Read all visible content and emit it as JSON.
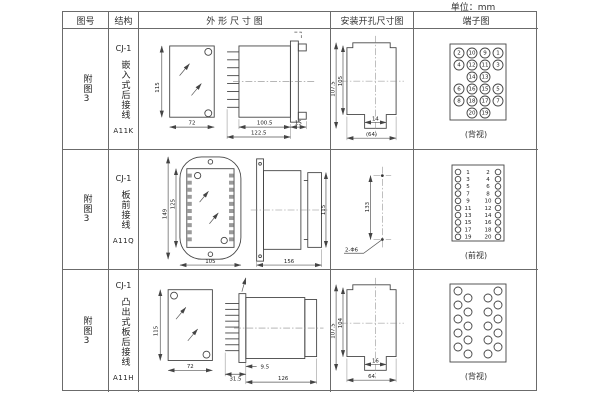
{
  "page": {
    "unit_note": "单位：mm"
  },
  "table": {
    "headers": {
      "fig_no": "图号",
      "structure": "结构",
      "outline": "外 形 尺 寸 图",
      "install": "安装开孔尺寸图",
      "terminal": "端子图"
    },
    "rows": [
      {
        "fig_no": "附图3",
        "structure": {
          "model": "CJ-1",
          "desc": "嵌入式后接线",
          "code": "A11K"
        },
        "outline_dims": {
          "front_h": "115",
          "front_w": "72",
          "side_body": "100.5",
          "side_total": "122.5",
          "side_rear": "15"
        },
        "install_dims": {
          "outer_h": "107.5",
          "inner_h": "105",
          "notch_w": "14",
          "total_w": "(64)"
        },
        "terminal": {
          "caption": "(背视)",
          "layout": "grid",
          "rows": [
            [
              "2",
              "10",
              "9",
              "1"
            ],
            [
              "4",
              "12",
              "11",
              "3"
            ],
            [
              "14",
              "13"
            ],
            [
              "6",
              "16",
              "15",
              "5"
            ],
            [
              "8",
              "18",
              "17",
              "7"
            ],
            [
              "20",
              "19"
            ]
          ]
        }
      },
      {
        "fig_no": "附图3",
        "structure": {
          "model": "CJ-1",
          "desc": "板前接线",
          "code": "A11Q"
        },
        "outline_dims": {
          "front_h_outer": "149",
          "front_h_inner": "125",
          "front_w": "105",
          "side_len": "156",
          "side_h": "115"
        },
        "install_dims": {
          "hole_dist": "133",
          "hole_label": "2-Φ6"
        },
        "terminal": {
          "caption": "(前视)",
          "layout": "two-col",
          "left": [
            "1",
            "3",
            "5",
            "7",
            "9",
            "11",
            "13",
            "15",
            "17",
            "19"
          ],
          "right": [
            "2",
            "4",
            "6",
            "8",
            "10",
            "12",
            "14",
            "16",
            "18",
            "20"
          ]
        }
      },
      {
        "fig_no": "附图3",
        "structure": {
          "model": "CJ-1",
          "desc": "凸出式板后接线",
          "code": "A11H"
        },
        "outline_dims": {
          "front_h": "115",
          "front_w": "72",
          "side_comb": "31.5",
          "side_gap": "9.5",
          "side_len": "126"
        },
        "install_dims": {
          "outer_h": "107.5",
          "inner_h": "104",
          "notch_w": "16",
          "total_w": "64"
        },
        "terminal": {
          "caption": "(背视)",
          "layout": "staggered",
          "count": 20
        }
      }
    ]
  }
}
